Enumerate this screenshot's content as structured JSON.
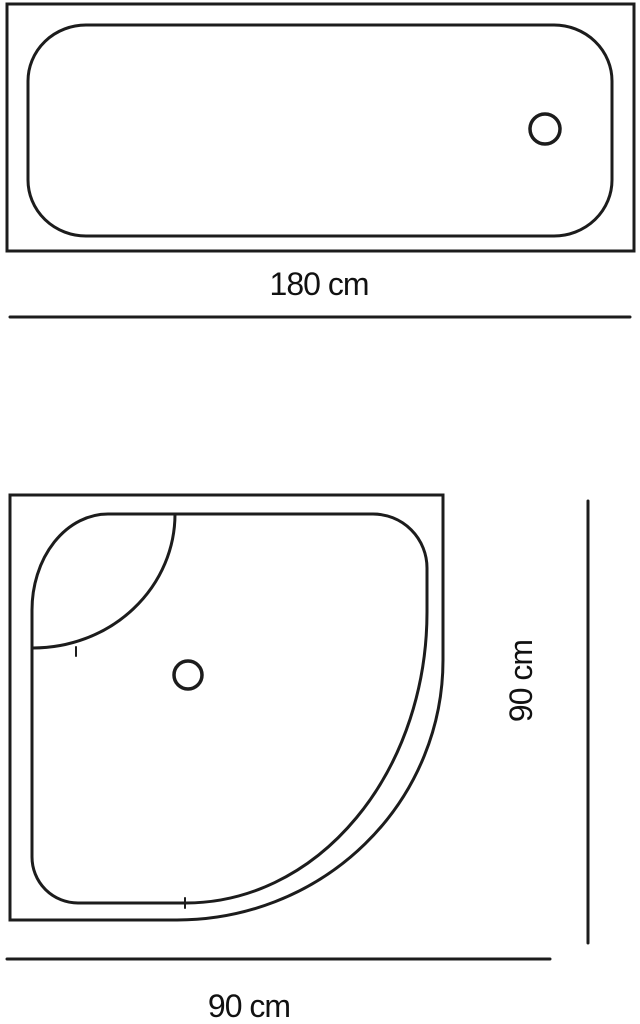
{
  "page": {
    "title": "Bathtub and shower tray dimension drawing",
    "background_color": "#ffffff",
    "line_color": "#1c1c1c",
    "text_color": "#111111"
  },
  "bathtub": {
    "description": "bathtub top view with drain",
    "dimension_label": "180 cm"
  },
  "shower_tray": {
    "description": "quadrant shower tray top view with corner seat and drain",
    "height_label": "90 cm",
    "width_label": "90 cm"
  }
}
